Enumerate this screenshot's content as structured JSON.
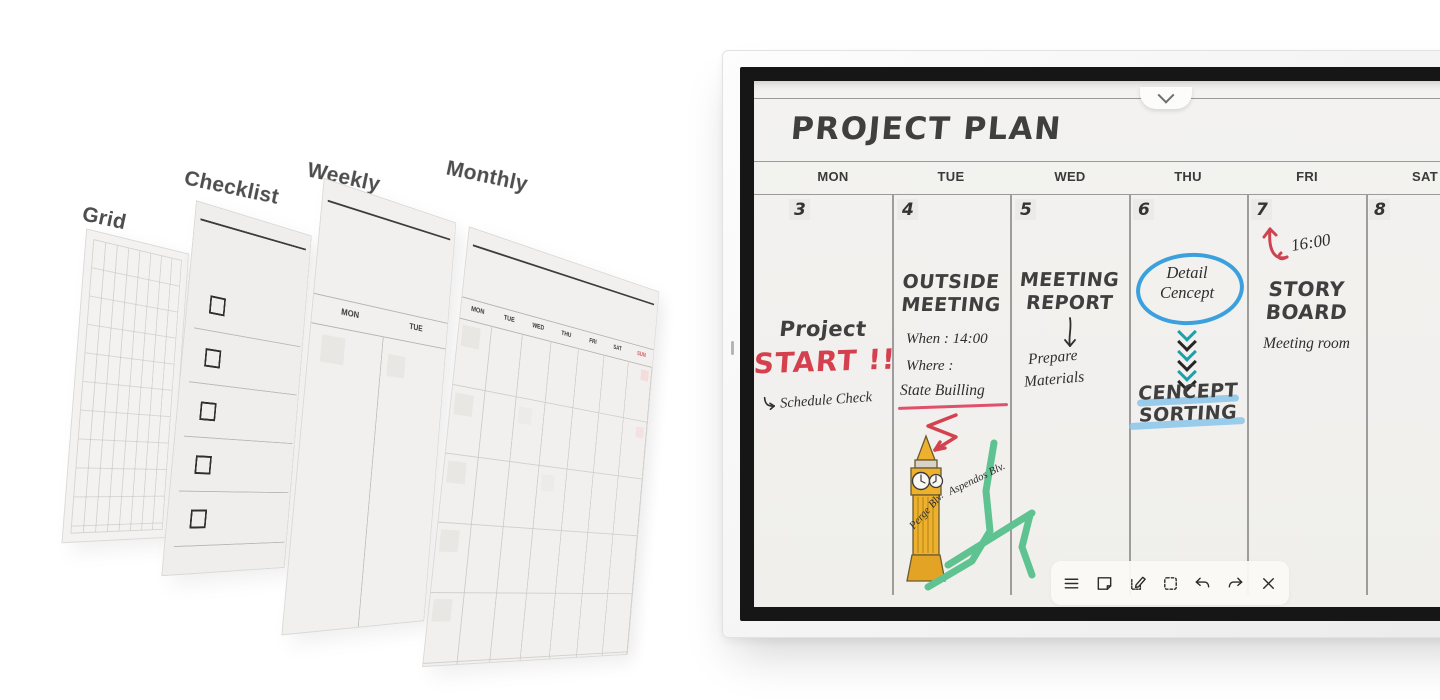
{
  "templates": {
    "grid": {
      "label": "Grid"
    },
    "checklist": {
      "label": "Checklist",
      "item_count": 5
    },
    "weekly": {
      "label": "Weekly",
      "days": [
        "MON",
        "TUE"
      ]
    },
    "monthly": {
      "label": "Monthly",
      "days": [
        "MON",
        "TUE",
        "WED",
        "THU",
        "FRI",
        "SAT",
        "SUN"
      ],
      "sunday_color": "#d85358"
    }
  },
  "board": {
    "title": "PROJECT PLAN",
    "days": [
      "MON",
      "TUE",
      "WED",
      "THU",
      "FRI",
      "SAT"
    ],
    "dates": [
      "3",
      "4",
      "5",
      "6",
      "7",
      "8"
    ],
    "columns": {
      "mon": {
        "title_line1": "Project",
        "title_line2": "START !!",
        "note": "Schedule Check"
      },
      "tue": {
        "heading_line1": "OUTSIDE",
        "heading_line2": "MEETING",
        "when_label": "When : 14:00",
        "where_label": "Where :",
        "location": "State Builling",
        "streets": [
          "Aspendos Blv.",
          "Perge Blv."
        ]
      },
      "wed": {
        "heading_line1": "MEETING",
        "heading_line2": "REPORT",
        "note_line1": "Prepare",
        "note_line2": "Materials"
      },
      "thu": {
        "circled_line1": "Detail",
        "circled_line2": "Cencept",
        "heading_line1": "CENCEPT",
        "heading_line2": "SORTING"
      },
      "fri": {
        "time": "16:00",
        "heading_line1": "STORY",
        "heading_line2": "BOARD",
        "note": "Meeting room"
      },
      "sat": {
        "content": ""
      }
    },
    "toolbar_icons": [
      "menu",
      "sticky-note",
      "edit-note",
      "select-area",
      "undo",
      "redo",
      "close"
    ]
  },
  "colors": {
    "screen_bg": "#f2f1ee",
    "marker": "#3f3f3f",
    "accent_red": "#d5404e",
    "accent_blue": "#3ba0dd",
    "accent_teal": "#1f9fa8",
    "map_green": "#5fc291",
    "bigben_yellow": "#edb12e",
    "highlight_blue": "#8ac4e9"
  }
}
